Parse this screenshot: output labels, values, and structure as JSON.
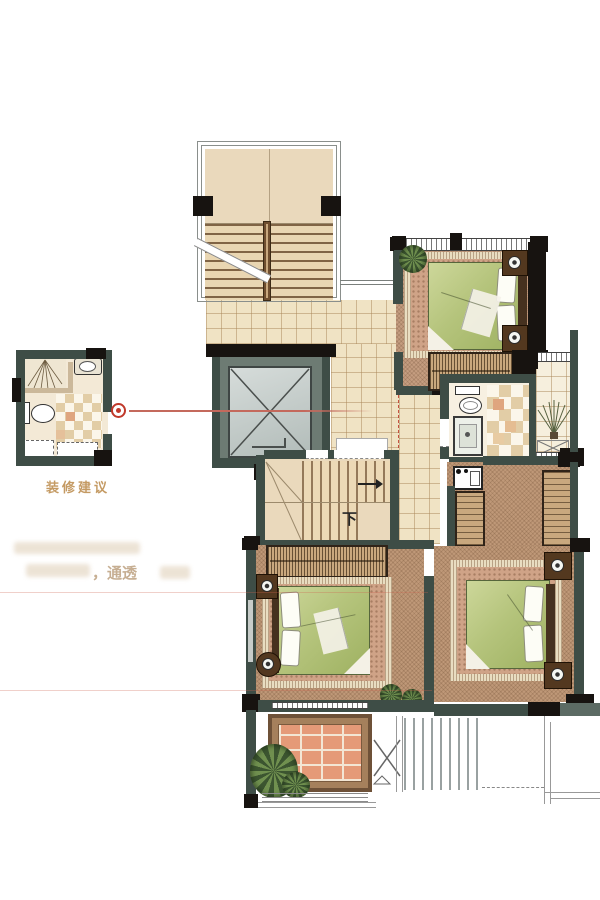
{
  "inset": {
    "caption": "装修建议"
  },
  "labels": {
    "down": "下"
  },
  "watermark": {
    "fragment": "，通透"
  },
  "palette": {
    "wall": "#3e4d46",
    "black": "#171310",
    "wood": "#ead9bc",
    "tile": "#f0e3c4",
    "carpet_brown": "#bf9878",
    "carpet_pink": "#c59d80",
    "bed_green": "#b5c47c",
    "rugband": "#e9ddc1",
    "rug_inner": "#cfa387",
    "orange": "#e59a78",
    "red": "#c0392b",
    "redline": "#c4695c",
    "gold": "#c49a63",
    "checker": "#e2cda6"
  }
}
